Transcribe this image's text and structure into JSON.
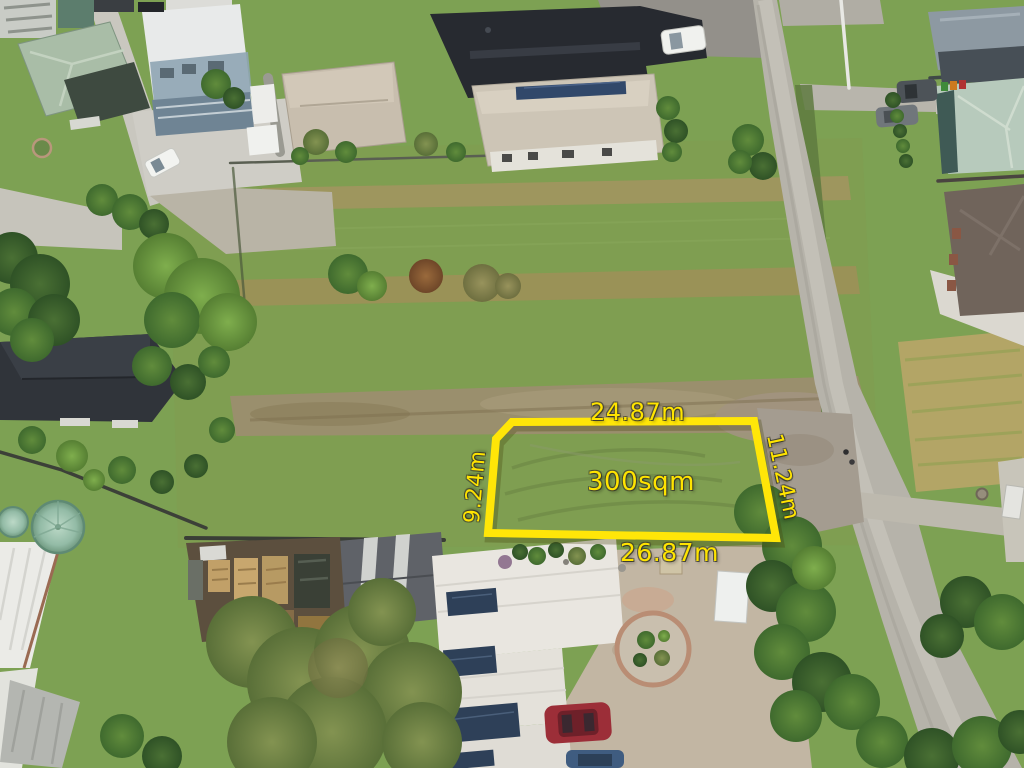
{
  "annotations": {
    "area": "300sqm",
    "boundary": {
      "top": "24.87m",
      "right": "11.24m",
      "bottom": "26.87m",
      "left": "9.24m"
    },
    "accent_color": "#ffe400"
  }
}
